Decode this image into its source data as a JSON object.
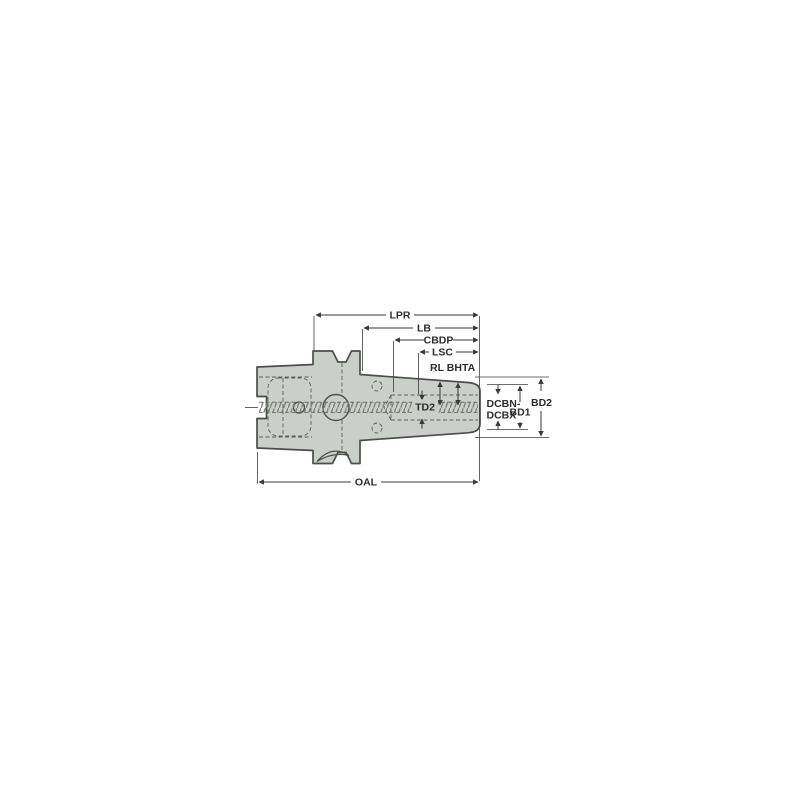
{
  "diagram": {
    "type": "technical-drawing",
    "subject": "shrink-fit tool holder (HSK shank) side view with dimension callouts",
    "colors": {
      "background": "#ffffff",
      "body_fill": "#cacfc9",
      "outline": "#4b4e4b",
      "dimension_lines": "#3a3a3a",
      "dashed_hidden_lines": "#5c605c",
      "thread_hatch": "#7e847c",
      "text": "#2d2d2d"
    },
    "dimension_labels": {
      "lpr": "LPR",
      "lb": "LB",
      "cbdp": "CBDP",
      "lsc": "LSC",
      "rl": "RL",
      "bhta": "BHTA",
      "td2": "TD2",
      "dcbn_dcbx_line1": "DCBN-",
      "dcbn_dcbx_line2": "DCBX",
      "bd1": "BD1",
      "bd2": "BD2",
      "oal": "OAL"
    }
  }
}
